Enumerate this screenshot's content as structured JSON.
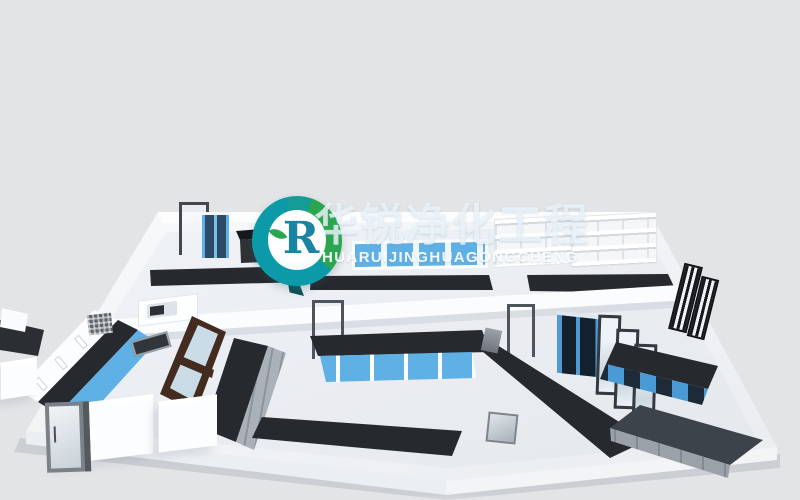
{
  "watermark": {
    "brand_cn": "华锐净化工程",
    "brand_en": "HUARUIJINGHUAGONGCHENG",
    "logo_monogram": "R"
  },
  "palette": {
    "bg": "#e2e4e6",
    "wall-white": "#f8fafc",
    "wall-shade": "#eceff2",
    "bench-black": "#26292d",
    "bench-gray": "#9aa1a8",
    "cabinet-blue": "#5fb0e4",
    "cabinet-blue-dark": "#2f6fa8",
    "frame-gray": "#4e545b",
    "wood-brown": "#432c1f",
    "glass-blue": "#d8e8f2",
    "logo-teal": "#0d9aa8",
    "logo-green": "#2aa64e",
    "watermark-text": "rgba(238,246,251,0.8)"
  }
}
